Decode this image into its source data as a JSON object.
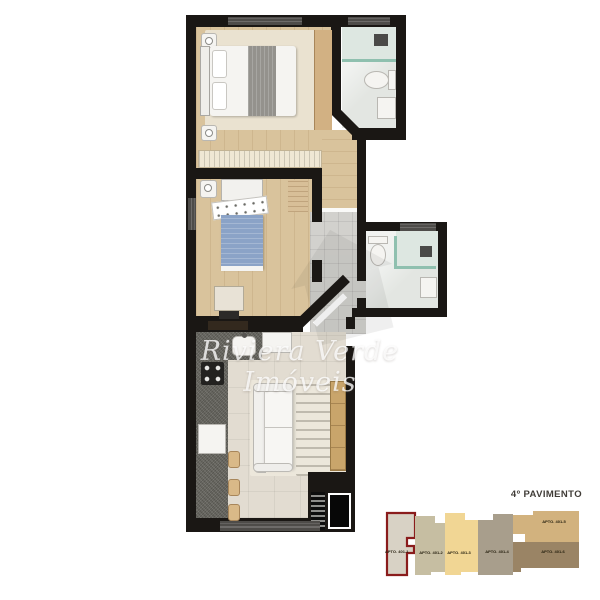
{
  "watermark": {
    "text": "Riviera Verde Imóveis"
  },
  "key_plan": {
    "title": "4º PAVIMENTO",
    "highlight_color": "#8a1c1c",
    "units": [
      {
        "label": "APTO. 401-1",
        "color": "#d8d2c5",
        "highlighted": true
      },
      {
        "label": "APTO. 401-2",
        "color": "#c6bea2",
        "highlighted": false
      },
      {
        "label": "APTO. 401-3",
        "color": "#f1d694",
        "highlighted": false
      },
      {
        "label": "APTO. 401-4",
        "color": "#a89e8c",
        "highlighted": false
      },
      {
        "label": "APTO. 401-5",
        "color": "#d2b27e",
        "highlighted": false
      },
      {
        "label": "APTO. 401-6",
        "color": "#9a8465",
        "highlighted": false
      }
    ]
  },
  "plan": {
    "colors": {
      "wall": "#1a1714",
      "wood_floor": "#d9c39c",
      "tile_light": "#e3e6e2",
      "tile_entry": "#d2d1cd",
      "tile_living": "#e2dcd1",
      "counter": "#6a6962",
      "glass": "#8fc0af"
    }
  }
}
